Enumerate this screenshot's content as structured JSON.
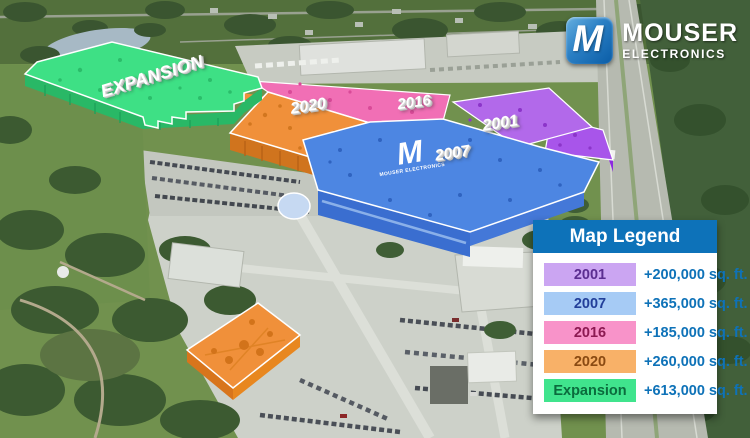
{
  "logo": {
    "mark": "M",
    "line1": "MOUSER",
    "line2": "ELECTRONICS"
  },
  "roof_logo": {
    "mark": "M",
    "subtext": "MOUSER ELECTRONICS"
  },
  "overlays": {
    "expansion": {
      "label": "EXPANSION",
      "color": "#3ee085"
    },
    "b2020": {
      "label": "2020",
      "color": "#f0903a"
    },
    "b2016": {
      "label": "2016",
      "color": "#f16fb5"
    },
    "b2001": {
      "label": "2001",
      "color": "#b269ea"
    },
    "b2007": {
      "label": "2007",
      "color": "#4d86e2"
    }
  },
  "legend": {
    "title": "Map Legend",
    "header_color": "#0d72b9",
    "value_color": "#0e72b8",
    "rows": [
      {
        "label": "2001",
        "chip_color": "#cba5f2",
        "text_color": "#5b2d90",
        "value": "+200,000 sq. ft."
      },
      {
        "label": "2007",
        "chip_color": "#a6cbf5",
        "text_color": "#223f99",
        "value": "+365,000 sq. ft."
      },
      {
        "label": "2016",
        "chip_color": "#f893c9",
        "text_color": "#8c1a52",
        "value": "+185,000 sq. ft."
      },
      {
        "label": "2020",
        "chip_color": "#f8b168",
        "text_color": "#8a4a12",
        "value": "+260,000 sq. ft."
      },
      {
        "label": "Expansion",
        "chip_color": "#40e48d",
        "text_color": "#0b6b3d",
        "value": "+613,000 sq. ft."
      }
    ]
  }
}
